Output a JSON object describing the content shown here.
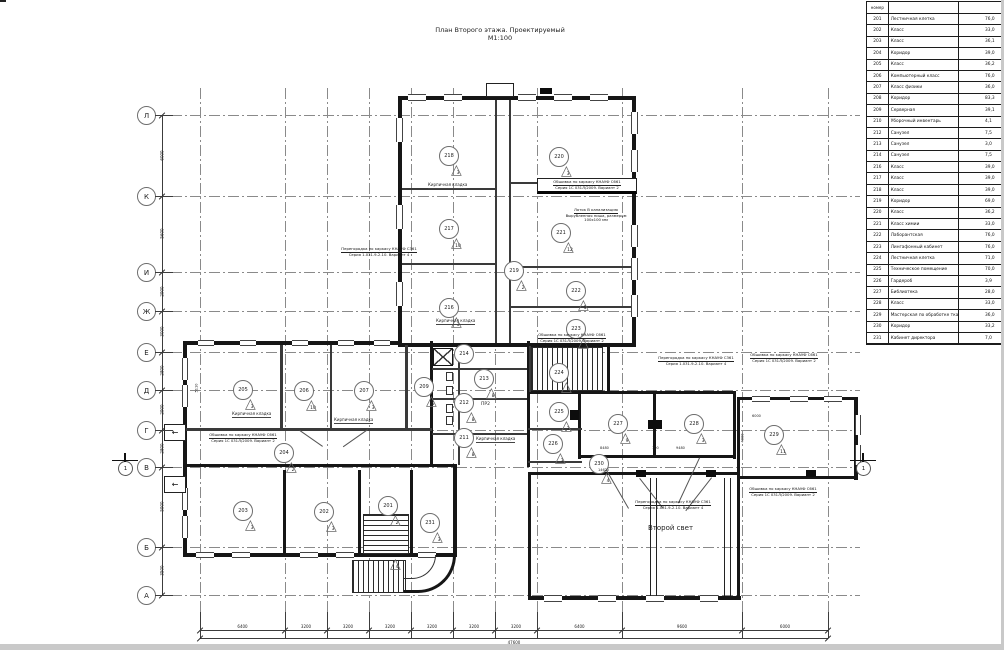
{
  "title": {
    "line1": "План Второго этажа. Проектируемый",
    "line2": "М1:100"
  },
  "colors": {
    "wall": "#161616",
    "thin_line": "#3a3a3a",
    "grid": "#8a8a8a",
    "text": "#1a1a1a"
  },
  "schedule": {
    "header": {
      "num": "номер",
      "name": "",
      "area": ""
    },
    "rows": [
      {
        "num": "201",
        "name": "Лестничная клетка",
        "area": "76,0"
      },
      {
        "num": "202",
        "name": "Класс",
        "area": "33,0"
      },
      {
        "num": "203",
        "name": "Класс",
        "area": "36,1"
      },
      {
        "num": "204",
        "name": "Коридор",
        "area": "39,0"
      },
      {
        "num": "205",
        "name": "Класс",
        "area": "36,2"
      },
      {
        "num": "206",
        "name": "Компьютерный класс",
        "area": "76,0"
      },
      {
        "num": "207",
        "name": "Класс физики",
        "area": "36,0"
      },
      {
        "num": "208",
        "name": "Коридор",
        "area": "83,3"
      },
      {
        "num": "209",
        "name": "Серверная",
        "area": "39,1"
      },
      {
        "num": "210",
        "name": "Уборочный инвентарь",
        "area": "4,1"
      },
      {
        "num": "212",
        "name": "Санузел",
        "area": "7,5"
      },
      {
        "num": "213",
        "name": "Санузел",
        "area": "3,0"
      },
      {
        "num": "214",
        "name": "Санузел",
        "area": "7,5"
      },
      {
        "num": "216",
        "name": "Класс",
        "area": "39,0"
      },
      {
        "num": "217",
        "name": "Класс",
        "area": "39,0"
      },
      {
        "num": "218",
        "name": "Класс",
        "area": "39,0"
      },
      {
        "num": "219",
        "name": "Коридор",
        "area": "69,0"
      },
      {
        "num": "220",
        "name": "Класс",
        "area": "36,2"
      },
      {
        "num": "221",
        "name": "Класс химии",
        "area": "33,0"
      },
      {
        "num": "222",
        "name": "Лаборантская",
        "area": "76,0"
      },
      {
        "num": "223",
        "name": "Лингафонный кабинет",
        "area": "76,0"
      },
      {
        "num": "224",
        "name": "Лестничная клетка",
        "area": "71,0"
      },
      {
        "num": "225",
        "name": "Техническое помещение",
        "area": "70,0"
      },
      {
        "num": "226",
        "name": "Гардероб",
        "area": "3,9"
      },
      {
        "num": "227",
        "name": "Библиотека",
        "area": "28,0"
      },
      {
        "num": "228",
        "name": "Класс",
        "area": "33,0"
      },
      {
        "num": "229",
        "name": "Мастерская по обработке тканей и технологии",
        "area": "36,0"
      },
      {
        "num": "230",
        "name": "Коридор",
        "area": "33,2"
      },
      {
        "num": "231",
        "name": "Кабинет директора",
        "area": "7,0"
      }
    ]
  },
  "axes": {
    "letters": [
      [
        "Л",
        115
      ],
      [
        "К",
        196
      ],
      [
        "И",
        272
      ],
      [
        "Ж",
        311
      ],
      [
        "Е",
        352
      ],
      [
        "Д",
        390
      ],
      [
        "Г",
        430
      ],
      [
        "В",
        467
      ],
      [
        "Б",
        547
      ],
      [
        "А",
        595
      ]
    ],
    "verticalsX": [
      200,
      285,
      327,
      369,
      411,
      453,
      495,
      537,
      622,
      742,
      828
    ]
  },
  "dims": {
    "bottom": {
      "values": [
        "6400",
        "3200",
        "3200",
        "3200",
        "3200",
        "3200",
        "3200",
        "6400",
        "9600",
        "6000"
      ],
      "total": "47600"
    },
    "left": {
      "values": [
        "6000",
        "5600",
        "2900",
        "3000",
        "2800",
        "2900",
        "2800",
        "5900",
        "3500"
      ]
    }
  },
  "plan": {
    "rooms": [
      {
        "num": "218",
        "x": 448,
        "y": 155,
        "tri": "3"
      },
      {
        "num": "220",
        "x": 558,
        "y": 156,
        "tri": "3"
      },
      {
        "num": "217",
        "x": 448,
        "y": 228,
        "tri": "10"
      },
      {
        "num": "221",
        "x": 560,
        "y": 232,
        "tri": "12"
      },
      {
        "num": "216",
        "x": 448,
        "y": 307,
        "tri": "3"
      },
      {
        "num": "222",
        "x": 575,
        "y": 290,
        "tri": "5"
      },
      {
        "num": "223",
        "x": 575,
        "y": 328,
        "tri": "3"
      },
      {
        "num": "219",
        "x": 513,
        "y": 270,
        "tri": "2"
      },
      {
        "num": "214",
        "x": 463,
        "y": 353,
        "tri": null
      },
      {
        "num": "213",
        "x": 483,
        "y": 378,
        "tri": "8"
      },
      {
        "num": "212",
        "x": 463,
        "y": 402,
        "tri": "8"
      },
      {
        "num": "211",
        "x": 463,
        "y": 437,
        "tri": "8"
      },
      {
        "num": "224",
        "x": 558,
        "y": 372,
        "tri": "2"
      },
      {
        "num": "205",
        "x": 242,
        "y": 389,
        "tri": "3"
      },
      {
        "num": "206",
        "x": 303,
        "y": 390,
        "tri": "10"
      },
      {
        "num": "207",
        "x": 363,
        "y": 390,
        "tri": "3"
      },
      {
        "num": "209",
        "x": 423,
        "y": 386,
        "tri": "5"
      },
      {
        "num": "204",
        "x": 283,
        "y": 452,
        "tri": "2"
      },
      {
        "num": "225",
        "x": 558,
        "y": 411,
        "tri": "3"
      },
      {
        "num": "226",
        "x": 552,
        "y": 443,
        "tri": "3"
      },
      {
        "num": "227",
        "x": 617,
        "y": 423,
        "tri": "9"
      },
      {
        "num": "228",
        "x": 693,
        "y": 423,
        "tri": "3"
      },
      {
        "num": "229",
        "x": 773,
        "y": 434,
        "tri": "11"
      },
      {
        "num": "230",
        "x": 598,
        "y": 463,
        "tri": "4"
      },
      {
        "num": "203",
        "x": 242,
        "y": 510,
        "tri": "3"
      },
      {
        "num": "202",
        "x": 323,
        "y": 511,
        "tri": "3"
      },
      {
        "num": "201",
        "x": 387,
        "y": 505,
        "tri": "2"
      },
      {
        "num": "231",
        "x": 429,
        "y": 522,
        "tri": "3"
      }
    ],
    "loose_triangles": [
      {
        "v": "4",
        "x": 390,
        "y": 560
      }
    ],
    "brick_labels": [
      {
        "text": "Кирпичная кладка",
        "x": 428,
        "y": 182
      },
      {
        "text": "Кирпичная кладка",
        "x": 436,
        "y": 318
      },
      {
        "text": "Кирпичная кладка",
        "x": 232,
        "y": 411
      },
      {
        "text": "Кирпичная кладка",
        "x": 334,
        "y": 417
      },
      {
        "text": "Кирпичная кладка",
        "x": 476,
        "y": 436
      }
    ],
    "notes": [
      {
        "x": 537,
        "y": 178,
        "w": 94,
        "boxed": true,
        "lines": [
          "Обшивка по каркасу КНАУФ С661",
          "Серия 1С 031Л/2009. Вариант 2"
        ]
      },
      {
        "x": 552,
        "y": 208,
        "w": 88,
        "boxed": false,
        "lines": [
          "Лоток В канализацию",
          "Вырубленная ниша, размером",
          "100х100 мм"
        ]
      },
      {
        "x": 528,
        "y": 333,
        "w": 88,
        "boxed": false,
        "lines": [
          "Обшивка по каркасу КНАУФ С661",
          "Серия 1С 031Л/2009. Вариант 2"
        ]
      },
      {
        "x": 330,
        "y": 247,
        "w": 98,
        "boxed": false,
        "lines": [
          "Перегородка по каркасу КНАУФ С361",
          "Серия 1.031.9-2.10. Вариант 4"
        ]
      },
      {
        "x": 200,
        "y": 433,
        "w": 86,
        "boxed": false,
        "lines": [
          "Обшивка по каркасу КНАУФ С661",
          "Серия 1С 031Л/2009. Вариант 2"
        ]
      },
      {
        "x": 655,
        "y": 356,
        "w": 82,
        "boxed": false,
        "lines": [
          "Перегородка по каркасу КНАУФ С361",
          "Серия 1.031.9-2.10. Вариант 4"
        ]
      },
      {
        "x": 744,
        "y": 353,
        "w": 80,
        "boxed": false,
        "lines": [
          "Обшивка по каркасу КНАУФ С661",
          "Серия 1С 031Л/2009. Вариант 2"
        ]
      },
      {
        "x": 625,
        "y": 500,
        "w": 96,
        "boxed": false,
        "lines": [
          "Перегородка по каркасу КНАУФ С361",
          "Серия 1.031.9-2.10. Вариант 4"
        ]
      },
      {
        "x": 742,
        "y": 487,
        "w": 82,
        "boxed": false,
        "lines": [
          "Обшивка по каркасу КНАУФ С661",
          "Серия 1С 031Л/2009. Вариант 2"
        ]
      }
    ],
    "texts": [
      {
        "t": "Второй свет",
        "x": 648,
        "y": 524,
        "s": 7,
        "rot": false
      },
      {
        "t": "ПР2",
        "x": 481,
        "y": 402,
        "s": 4.5,
        "rot": false
      },
      {
        "t": "8480",
        "x": 600,
        "y": 446,
        "s": 3.5,
        "rot": false
      },
      {
        "t": "100",
        "x": 652,
        "y": 446,
        "s": 3.5,
        "rot": false
      },
      {
        "t": "9480",
        "x": 676,
        "y": 446,
        "s": 3.5,
        "rot": false
      },
      {
        "t": "14620",
        "x": 598,
        "y": 468,
        "s": 3.5,
        "rot": false
      },
      {
        "t": "6000",
        "x": 752,
        "y": 414,
        "s": 3.5,
        "rot": false
      },
      {
        "t": "4000",
        "x": 738,
        "y": 436,
        "s": 3.5,
        "rot": true
      },
      {
        "t": "5110",
        "x": 192,
        "y": 386,
        "s": 3.5,
        "rot": true
      }
    ],
    "walls": [
      [
        398,
        96,
        238,
        4
      ],
      [
        398,
        96,
        4,
        251
      ],
      [
        632,
        96,
        4,
        251
      ],
      [
        398,
        343,
        238,
        4
      ],
      [
        183,
        341,
        219,
        4
      ],
      [
        183,
        341,
        4,
        216
      ],
      [
        183,
        553,
        274,
        4
      ],
      [
        453,
        467,
        4,
        90
      ],
      [
        430,
        341,
        3,
        126
      ],
      [
        527,
        341,
        3,
        126
      ],
      [
        528,
        391,
        54,
        3
      ],
      [
        578,
        391,
        158,
        3
      ],
      [
        733,
        391,
        3,
        68
      ],
      [
        578,
        391,
        3,
        68
      ],
      [
        578,
        455,
        158,
        3
      ],
      [
        653,
        391,
        3,
        66
      ],
      [
        528,
        472,
        212,
        3
      ],
      [
        528,
        472,
        3,
        128
      ],
      [
        737,
        397,
        3,
        203
      ],
      [
        528,
        596,
        213,
        4
      ],
      [
        737,
        397,
        121,
        3
      ],
      [
        854,
        397,
        4,
        83
      ],
      [
        737,
        476,
        121,
        3
      ],
      [
        607,
        343,
        3,
        50
      ],
      [
        183,
        464,
        274,
        3
      ],
      [
        358,
        470,
        3,
        85
      ],
      [
        410,
        470,
        3,
        85
      ],
      [
        283,
        470,
        3,
        85
      ]
    ],
    "thin_walls": [
      [
        495,
        100,
        2,
        243
      ],
      [
        509,
        100,
        2,
        243
      ],
      [
        402,
        188,
        93,
        2
      ],
      [
        402,
        263,
        93,
        2
      ],
      [
        511,
        182,
        121,
        2
      ],
      [
        511,
        266,
        121,
        2
      ],
      [
        511,
        306,
        121,
        2
      ],
      [
        280,
        345,
        3,
        84
      ],
      [
        330,
        345,
        2,
        84
      ],
      [
        405,
        345,
        3,
        84
      ],
      [
        186,
        428,
        246,
        3
      ],
      [
        432,
        368,
        95,
        2
      ],
      [
        432,
        398,
        95,
        2
      ],
      [
        432,
        433,
        95,
        2
      ],
      [
        458,
        345,
        2,
        120
      ],
      [
        528,
        428,
        54,
        2
      ],
      [
        528,
        461,
        54,
        2
      ],
      [
        529,
        346,
        2,
        46
      ]
    ],
    "boxes": [
      [
        486,
        83,
        28,
        14
      ]
    ],
    "piers": [
      [
        648,
        420,
        14,
        9
      ],
      [
        570,
        410,
        9,
        10
      ],
      [
        636,
        470,
        10,
        7
      ],
      [
        706,
        470,
        10,
        7
      ],
      [
        806,
        470,
        10,
        7
      ],
      [
        540,
        88,
        12,
        6
      ]
    ],
    "windows": [
      [
        408,
        94,
        18,
        7,
        "h"
      ],
      [
        444,
        94,
        18,
        7,
        "h"
      ],
      [
        518,
        94,
        18,
        7,
        "h"
      ],
      [
        554,
        94,
        18,
        7,
        "h"
      ],
      [
        590,
        94,
        18,
        7,
        "h"
      ],
      [
        396,
        118,
        7,
        24,
        "v"
      ],
      [
        396,
        205,
        7,
        24,
        "v"
      ],
      [
        396,
        282,
        7,
        24,
        "v"
      ],
      [
        631,
        112,
        7,
        22,
        "v"
      ],
      [
        631,
        150,
        7,
        22,
        "v"
      ],
      [
        631,
        225,
        7,
        22,
        "v"
      ],
      [
        631,
        258,
        7,
        22,
        "v"
      ],
      [
        631,
        295,
        7,
        22,
        "v"
      ],
      [
        198,
        340,
        16,
        6,
        "h"
      ],
      [
        240,
        340,
        16,
        6,
        "h"
      ],
      [
        292,
        340,
        16,
        6,
        "h"
      ],
      [
        338,
        340,
        16,
        6,
        "h"
      ],
      [
        374,
        340,
        16,
        6,
        "h"
      ],
      [
        182,
        358,
        6,
        22,
        "v"
      ],
      [
        182,
        385,
        6,
        22,
        "v"
      ],
      [
        182,
        488,
        6,
        22,
        "v"
      ],
      [
        182,
        516,
        6,
        22,
        "v"
      ],
      [
        196,
        552,
        18,
        6,
        "h"
      ],
      [
        232,
        552,
        18,
        6,
        "h"
      ],
      [
        300,
        552,
        18,
        6,
        "h"
      ],
      [
        336,
        552,
        18,
        6,
        "h"
      ],
      [
        418,
        552,
        18,
        6,
        "h"
      ],
      [
        544,
        595,
        18,
        7,
        "h"
      ],
      [
        598,
        595,
        18,
        7,
        "h"
      ],
      [
        646,
        595,
        18,
        7,
        "h"
      ],
      [
        700,
        595,
        18,
        7,
        "h"
      ],
      [
        752,
        396,
        18,
        6,
        "h"
      ],
      [
        790,
        396,
        18,
        6,
        "h"
      ],
      [
        824,
        396,
        18,
        6,
        "h"
      ],
      [
        855,
        415,
        6,
        20,
        "v"
      ],
      [
        855,
        445,
        6,
        20,
        "v"
      ]
    ],
    "stairs": [
      {
        "x": 363,
        "y": 514,
        "w": 46,
        "h": 40,
        "dir": "h"
      },
      {
        "x": 531,
        "y": 347,
        "w": 72,
        "h": 44,
        "dir": "v"
      },
      {
        "x": 352,
        "y": 560,
        "w": 54,
        "h": 33,
        "dir": "v"
      }
    ],
    "lift": {
      "x": 433,
      "y": 348,
      "w": 20,
      "h": 18
    },
    "fixtures": [
      [
        446,
        372,
        7,
        9
      ],
      [
        446,
        386,
        7,
        9
      ],
      [
        446,
        404,
        7,
        9
      ],
      [
        446,
        416,
        7,
        9
      ]
    ],
    "hall_columns": [
      {
        "x": 650,
        "y": 478,
        "h": 118
      },
      {
        "x": 724,
        "y": 478,
        "h": 118
      }
    ],
    "leaders": [
      {
        "x": 640,
        "y": 478,
        "len": 38,
        "ang": 52
      },
      {
        "x": 712,
        "y": 478,
        "len": 42,
        "ang": 128
      },
      {
        "x": 368,
        "y": 430,
        "len": 30,
        "ang": 145
      },
      {
        "x": 300,
        "y": 430,
        "len": 28,
        "ang": 35
      },
      {
        "x": 600,
        "y": 458,
        "len": 58,
        "ang": 60
      },
      {
        "x": 700,
        "y": 458,
        "len": 50,
        "ang": 115
      }
    ],
    "entries": [
      {
        "x": 164,
        "y": 424,
        "glyph": "←"
      },
      {
        "x": 164,
        "y": 476,
        "glyph": "←"
      }
    ],
    "sections": [
      {
        "x": 118,
        "y": 461,
        "label": "1"
      },
      {
        "x": 856,
        "y": 461,
        "label": "1"
      }
    ],
    "curve": {
      "x": 404,
      "y": 555,
      "w": 52,
      "h": 38
    }
  }
}
